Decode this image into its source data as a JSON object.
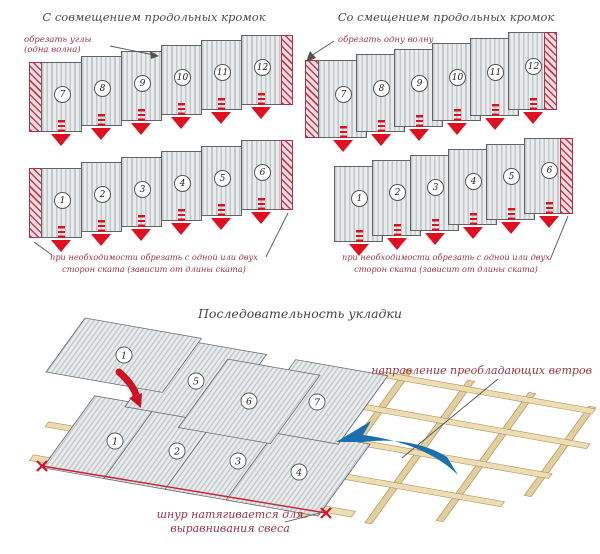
{
  "panel_left": {
    "title": "С совмещением продольных кромок",
    "cut_note_line1": "обрезать углы",
    "cut_note_line2": "(одна волна)",
    "top_row": [
      "7",
      "8",
      "9",
      "10",
      "11",
      "12"
    ],
    "bottom_row": [
      "1",
      "2",
      "3",
      "4",
      "5",
      "6"
    ],
    "caption_line1": "при необходимости обрезать с одной или двух",
    "caption_line2": "сторон ската (зависит от длины ската)"
  },
  "panel_right": {
    "title": "Со смещением продольных кромок",
    "cut_note": "обрезать одну волну",
    "top_row": [
      "7",
      "8",
      "9",
      "10",
      "11",
      "12"
    ],
    "bottom_row": [
      "1",
      "2",
      "3",
      "4",
      "5",
      "6"
    ],
    "caption_line1": "при необходимости обрезать с одной или двух",
    "caption_line2": "сторон ската (зависит от длины ската)"
  },
  "sequence": {
    "title": "Последовательность укладки",
    "wind_label": "направление преобладающих ветров",
    "cord_label_line1": "шнур натягивается для",
    "cord_label_line2": "выравнивания свеса",
    "loose_sheet": "1",
    "front_row": [
      "1",
      "2",
      "3",
      "4"
    ],
    "back_row": [
      "5",
      "6",
      "7"
    ]
  },
  "colors": {
    "sheet_light": "#e9ebec",
    "sheet_dark": "#c3c8cb",
    "hatch_red": "#c5394f",
    "arrow_red": "#e01020",
    "label_maroon": "#9a3344",
    "title_gray": "#4a4a46",
    "wood": "#eedcb2",
    "wind_blue": "#1a6fad",
    "cord_red": "#cc2236"
  }
}
